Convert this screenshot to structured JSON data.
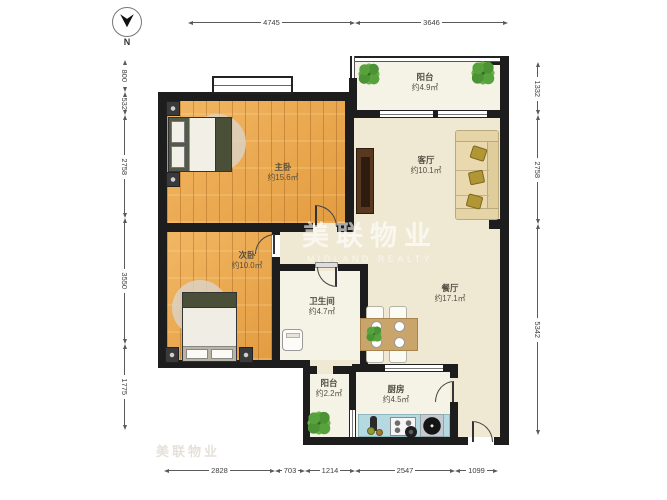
{
  "compass": {
    "label": "N"
  },
  "watermark": {
    "cn": "美联物业",
    "en": "MIDLAND REALTY",
    "cn_faint": "美联物业"
  },
  "rooms": {
    "master": {
      "name": "主卧",
      "area": "约15.6㎡"
    },
    "second": {
      "name": "次卧",
      "area": "约10.0㎡"
    },
    "living": {
      "name": "客厅",
      "area": "约10.1㎡"
    },
    "dining": {
      "name": "餐厅",
      "area": "约17.1㎡"
    },
    "bath": {
      "name": "卫生间",
      "area": "约4.7㎡"
    },
    "kitchen": {
      "name": "厨房",
      "area": "约4.5㎡"
    },
    "balcony_top": {
      "name": "阳台",
      "area": "约4.9㎡"
    },
    "balcony_bottom": {
      "name": "阳台",
      "area": "约2.2㎡"
    }
  },
  "dimensions": {
    "top": [
      "4745",
      "3646"
    ],
    "left": [
      "800",
      "532",
      "2758",
      "3550",
      "1775"
    ],
    "right": [
      "1332",
      "2758",
      "5342"
    ],
    "bottom": [
      "2828",
      "703",
      "1214",
      "2547",
      "1099"
    ]
  },
  "colors": {
    "wall": "#1d1d1d",
    "wood_floor": "#e8a84e",
    "public_floor": "#efe9d4",
    "wet_floor": "#f5f2e6",
    "counter": "#b5d9e0",
    "plant": "#4c9038",
    "sofa": "#ead9ae",
    "bed_accent": "#4a5038"
  }
}
